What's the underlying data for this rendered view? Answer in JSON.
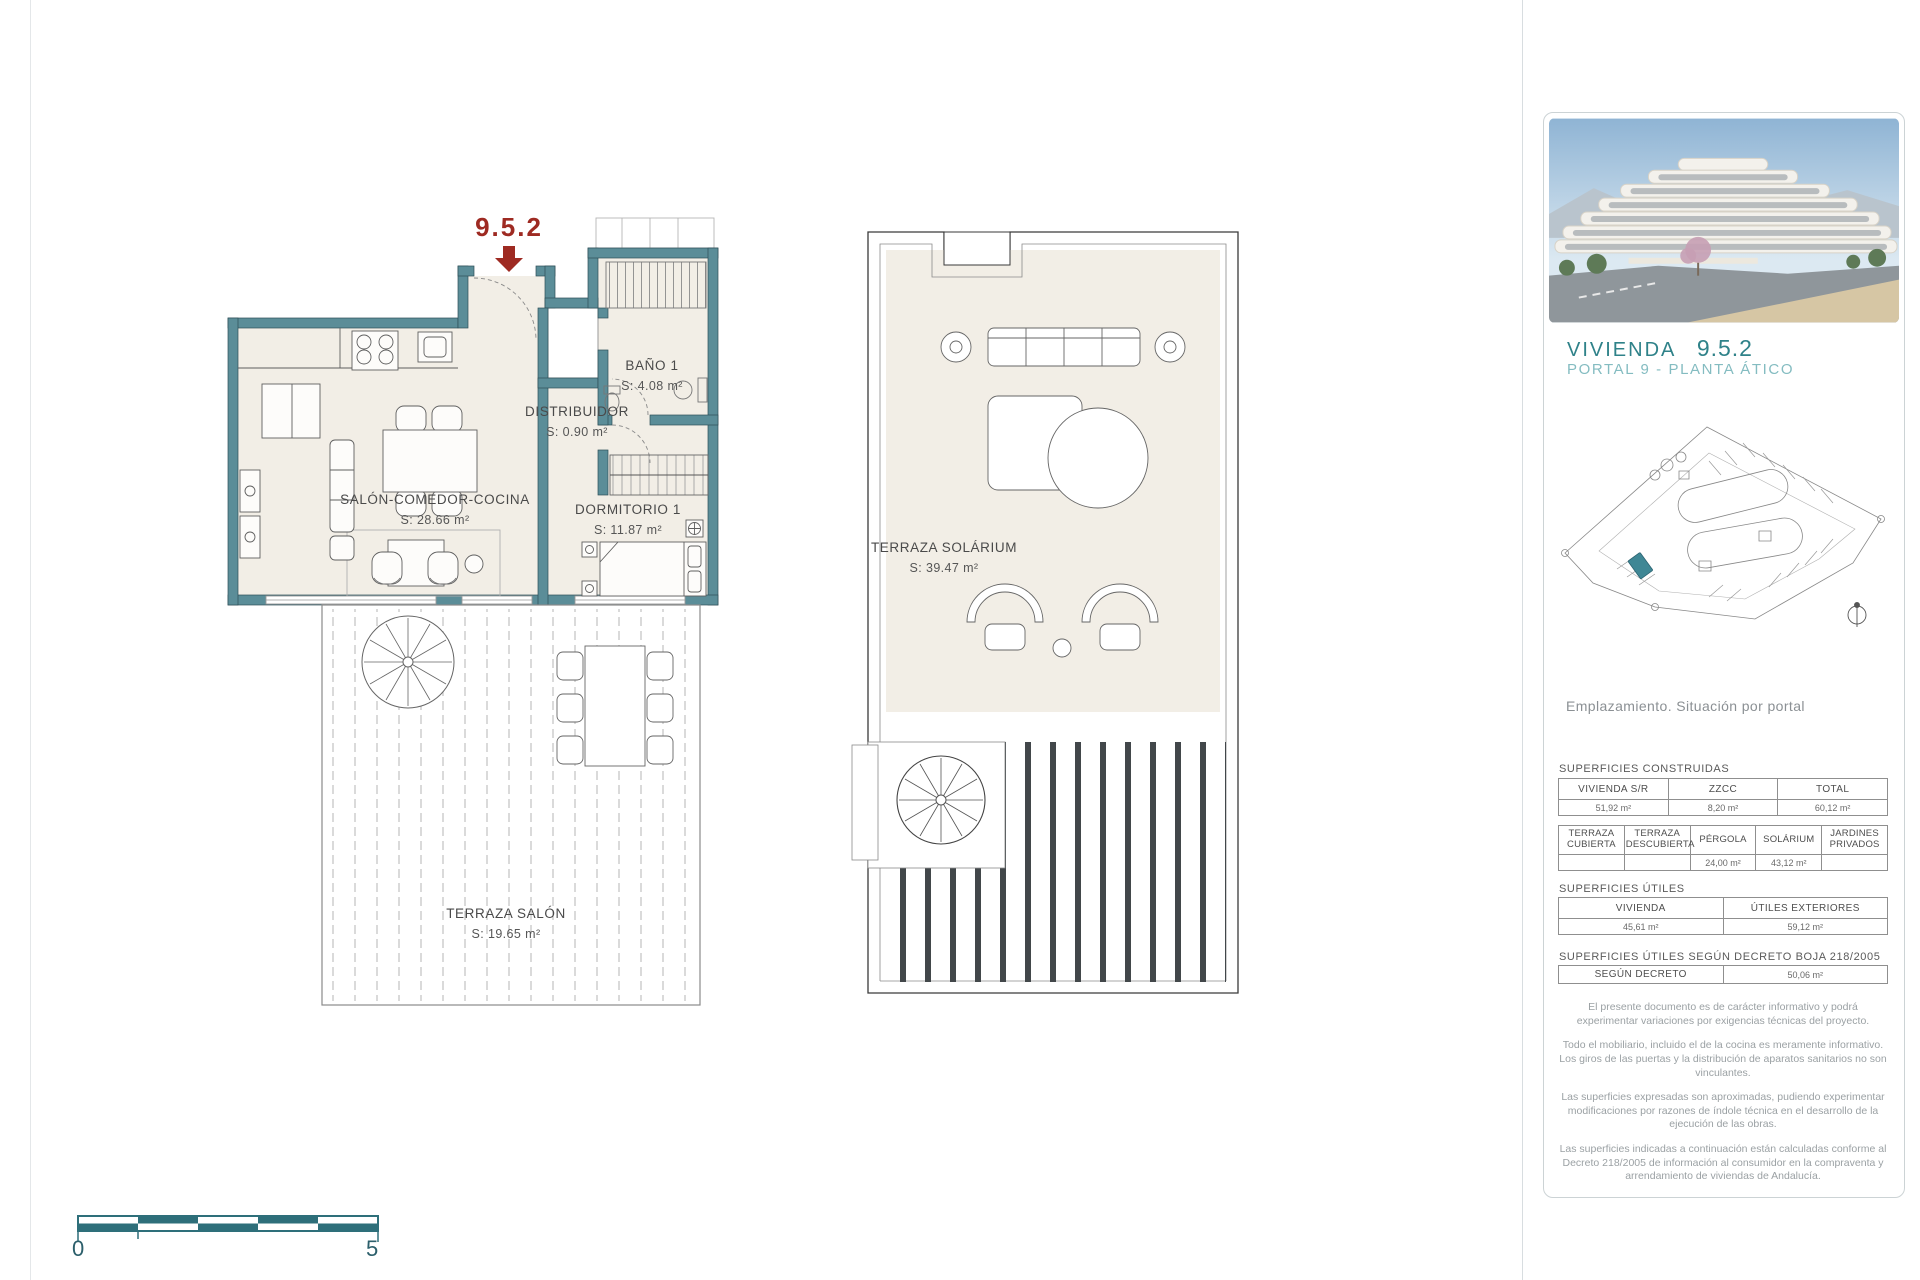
{
  "page": {
    "scale_start": "0",
    "scale_end": "5"
  },
  "plan_lower": {
    "unit_callout": "9.5.2",
    "rooms": {
      "salon": {
        "name": "SALÓN-COMEDOR-COCINA",
        "area": "S: 28.66 m²"
      },
      "distribuidor": {
        "name": "DISTRIBUIDOR",
        "area": "S: 0.90 m²"
      },
      "bano": {
        "name": "BAÑO 1",
        "area": "S: 4.08 m²"
      },
      "dormitorio": {
        "name": "DORMITORIO 1",
        "area": "S: 11.87 m²"
      },
      "terraza": {
        "name": "TERRAZA SALÓN",
        "area": "S: 19.65 m²"
      }
    }
  },
  "plan_upper": {
    "room": {
      "name": "TERRAZA SOLÁRIUM",
      "area": "S: 39.47 m²"
    }
  },
  "sidebar": {
    "title": "VIVIENDA",
    "unit": "9.5.2",
    "subtitle": "PORTAL 9 - PLANTA ÁTICO",
    "caption": "Emplazamiento. Situación por portal",
    "sections": {
      "construidas": {
        "title": "SUPERFICIES CONSTRUIDAS",
        "headers": [
          "VIVIENDA S/R",
          "ZZCC",
          "TOTAL"
        ],
        "values": [
          "51,92 m²",
          "8,20 m²",
          "60,12 m²"
        ]
      },
      "exteriores": {
        "headers": [
          "TERRAZA CUBIERTA",
          "TERRAZA DESCUBIERTA",
          "PÉRGOLA",
          "SOLÁRIUM",
          "JARDINES PRIVADOS"
        ],
        "values": [
          "",
          "",
          "24,00 m²",
          "43,12 m²",
          ""
        ]
      },
      "utiles": {
        "title": "SUPERFICIES ÚTILES",
        "headers": [
          "VIVIENDA",
          "ÚTILES EXTERIORES"
        ],
        "values": [
          "45,61 m²",
          "59,12 m²"
        ]
      },
      "decreto": {
        "title": "SUPERFICIES ÚTILES SEGÚN DECRETO BOJA 218/2005",
        "header": "SEGÚN DECRETO",
        "value": "50,06 m²"
      }
    },
    "disclaimers": [
      "El presente documento es de carácter informativo y podrá experimentar variaciones por exigencias técnicas del proyecto.",
      "Todo el mobiliario, incluido el de la cocina es meramente informativo. Los giros de las puertas y la distribución de aparatos sanitarios no son vinculantes.",
      "Las superficies expresadas son aproximadas, pudiendo experimentar modificaciones por razones de índole técnica en el desarrollo de la ejecución de las obras.",
      "Las superficies indicadas a continuación están calculadas conforme al Decreto 218/2005 de información al consumidor en la compraventa y arrendamiento de viviendas de Andalucía."
    ]
  },
  "colors": {
    "wall_teal": "#5b8d98",
    "accent_red": "#9e2a22",
    "brand_teal": "#2f8289",
    "brand_teal_light": "#84bcc1"
  }
}
